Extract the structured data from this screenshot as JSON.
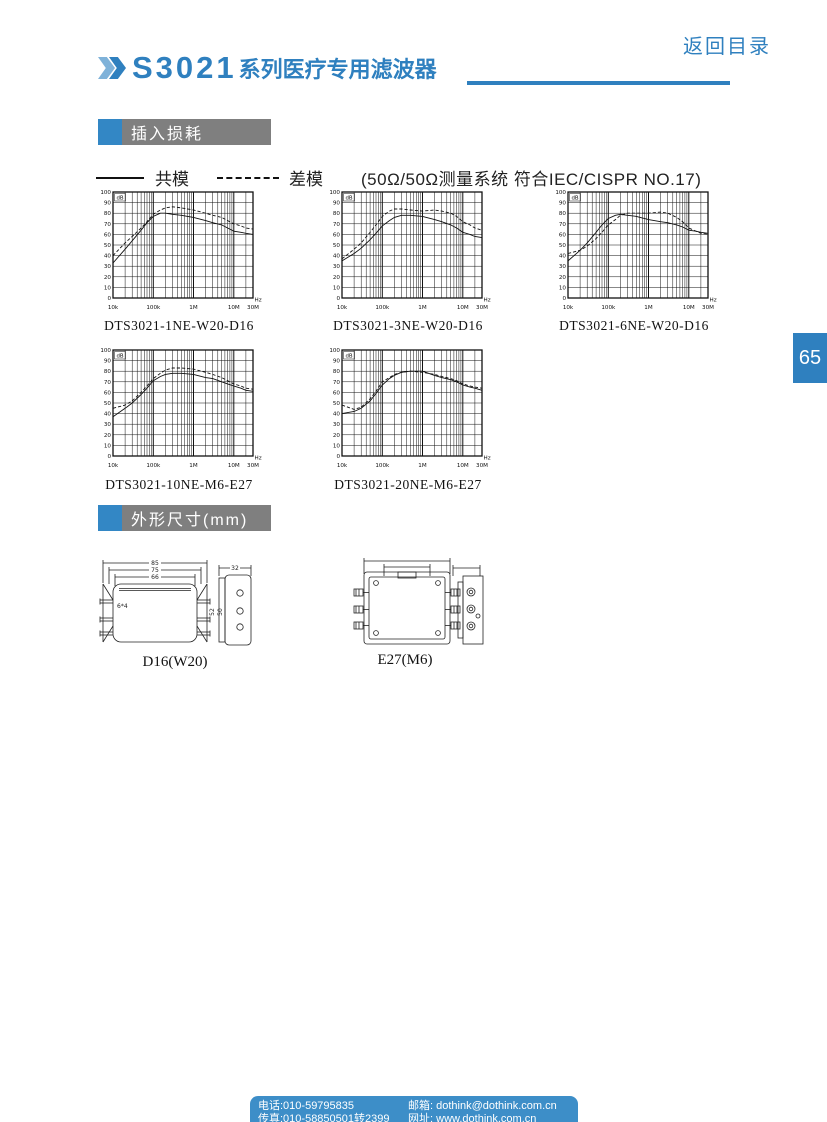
{
  "page": {
    "back_link": "返回目录",
    "page_number": "65"
  },
  "header": {
    "series_code": "S3021",
    "series_suffix": "系列医疗专用滤波器"
  },
  "sections": {
    "insertion_loss": "插入损耗",
    "dimensions": "外形尺寸(mm)"
  },
  "legend": {
    "common_mode": "共模",
    "differential_mode": "差模",
    "note": "(50Ω/50Ω测量系统 符合IEC/CISPR NO.17)"
  },
  "colors": {
    "accent_blue": "#2f80bf",
    "section_gray": "#7f7f7f",
    "footer_blue": "#3d8ec8",
    "line_black": "#111111"
  },
  "chart_data": [
    {
      "type": "line",
      "title": "DTS3021-1NE-W20-D16",
      "xlabel": "Hz",
      "ylabel": "dB",
      "x_scale": "log",
      "xlim": [
        10000,
        30000000
      ],
      "ylim": [
        0,
        100
      ],
      "y_tick_step": 10,
      "x_ticks": [
        "10k",
        "100k",
        "1M",
        "10M",
        "30M"
      ],
      "x_tick_values": [
        10000,
        100000,
        1000000,
        10000000,
        30000000
      ],
      "series": [
        {
          "name": "共模",
          "style": "solid",
          "x": [
            10000,
            20000,
            30000,
            50000,
            70000,
            100000,
            150000,
            200000,
            300000,
            500000,
            1000000,
            2000000,
            3000000,
            5000000,
            7000000,
            10000000,
            15000000,
            20000000,
            30000000
          ],
          "y": [
            33,
            46,
            54,
            64,
            71,
            77,
            80,
            80,
            79,
            78,
            76,
            73,
            71,
            69,
            66,
            63,
            62,
            61,
            60
          ]
        },
        {
          "name": "差模",
          "style": "dashed",
          "x": [
            10000,
            20000,
            30000,
            50000,
            70000,
            100000,
            150000,
            200000,
            300000,
            500000,
            1000000,
            2000000,
            3000000,
            5000000,
            7000000,
            10000000,
            15000000,
            20000000,
            30000000
          ],
          "y": [
            40,
            52,
            58,
            66,
            72,
            79,
            83,
            85,
            86,
            85,
            83,
            80,
            78,
            76,
            73,
            70,
            68,
            66,
            65
          ]
        }
      ]
    },
    {
      "type": "line",
      "title": "DTS3021-3NE-W20-D16",
      "xlabel": "Hz",
      "ylabel": "dB",
      "x_scale": "log",
      "xlim": [
        10000,
        30000000
      ],
      "ylim": [
        0,
        100
      ],
      "y_tick_step": 10,
      "x_ticks": [
        "10k",
        "100k",
        "1M",
        "10M",
        "30M"
      ],
      "x_tick_values": [
        10000,
        100000,
        1000000,
        10000000,
        30000000
      ],
      "series": [
        {
          "name": "共模",
          "style": "solid",
          "x": [
            10000,
            20000,
            30000,
            50000,
            70000,
            100000,
            150000,
            200000,
            300000,
            500000,
            1000000,
            2000000,
            3000000,
            5000000,
            7000000,
            10000000,
            15000000,
            20000000,
            30000000
          ],
          "y": [
            35,
            42,
            47,
            55,
            61,
            68,
            73,
            76,
            78,
            78,
            77,
            74,
            72,
            69,
            66,
            62,
            60,
            58,
            57
          ]
        },
        {
          "name": "差模",
          "style": "dashed",
          "x": [
            10000,
            20000,
            30000,
            50000,
            70000,
            100000,
            150000,
            200000,
            300000,
            500000,
            1000000,
            2000000,
            3000000,
            5000000,
            7000000,
            10000000,
            15000000,
            20000000,
            30000000
          ],
          "y": [
            37,
            46,
            52,
            62,
            69,
            77,
            82,
            84,
            84,
            83,
            82,
            83,
            82,
            80,
            77,
            72,
            69,
            66,
            64
          ]
        }
      ]
    },
    {
      "type": "line",
      "title": "DTS3021-6NE-W20-D16",
      "xlabel": "Hz",
      "ylabel": "dB",
      "x_scale": "log",
      "xlim": [
        10000,
        30000000
      ],
      "ylim": [
        0,
        100
      ],
      "y_tick_step": 10,
      "x_ticks": [
        "10k",
        "100k",
        "1M",
        "10M",
        "30M"
      ],
      "x_tick_values": [
        10000,
        100000,
        1000000,
        10000000,
        30000000
      ],
      "series": [
        {
          "name": "共模",
          "style": "solid",
          "x": [
            10000,
            20000,
            30000,
            50000,
            70000,
            100000,
            150000,
            200000,
            300000,
            500000,
            1000000,
            2000000,
            3000000,
            5000000,
            7000000,
            10000000,
            15000000,
            20000000,
            30000000
          ],
          "y": [
            35,
            45,
            52,
            62,
            69,
            75,
            78,
            79,
            78,
            77,
            74,
            72,
            71,
            69,
            67,
            64,
            63,
            62,
            61
          ]
        },
        {
          "name": "差模",
          "style": "dashed",
          "x": [
            10000,
            20000,
            30000,
            50000,
            70000,
            100000,
            150000,
            200000,
            300000,
            500000,
            1000000,
            2000000,
            3000000,
            5000000,
            7000000,
            10000000,
            15000000,
            20000000,
            30000000
          ],
          "y": [
            42,
            45,
            49,
            56,
            62,
            69,
            74,
            78,
            80,
            80,
            80,
            81,
            80,
            76,
            72,
            66,
            63,
            61,
            60
          ]
        }
      ]
    },
    {
      "type": "line",
      "title": "DTS3021-10NE-M6-E27",
      "xlabel": "Hz",
      "ylabel": "dB",
      "x_scale": "log",
      "xlim": [
        10000,
        30000000
      ],
      "ylim": [
        0,
        100
      ],
      "y_tick_step": 10,
      "x_ticks": [
        "10k",
        "100k",
        "1M",
        "10M",
        "30M"
      ],
      "x_tick_values": [
        10000,
        100000,
        1000000,
        10000000,
        30000000
      ],
      "series": [
        {
          "name": "共模",
          "style": "solid",
          "x": [
            10000,
            20000,
            30000,
            50000,
            70000,
            100000,
            150000,
            200000,
            300000,
            500000,
            1000000,
            2000000,
            3000000,
            5000000,
            7000000,
            10000000,
            15000000,
            20000000,
            30000000
          ],
          "y": [
            37,
            45,
            50,
            58,
            64,
            71,
            75,
            77,
            78,
            78,
            77,
            74,
            73,
            70,
            68,
            66,
            64,
            62,
            61
          ]
        },
        {
          "name": "差模",
          "style": "dashed",
          "x": [
            10000,
            20000,
            30000,
            50000,
            70000,
            100000,
            150000,
            200000,
            300000,
            500000,
            1000000,
            2000000,
            3000000,
            5000000,
            7000000,
            10000000,
            15000000,
            20000000,
            30000000
          ],
          "y": [
            45,
            48,
            52,
            60,
            66,
            73,
            78,
            81,
            83,
            83,
            82,
            79,
            77,
            74,
            71,
            68,
            66,
            64,
            63
          ]
        }
      ]
    },
    {
      "type": "line",
      "title": "DTS3021-20NE-M6-E27",
      "xlabel": "Hz",
      "ylabel": "dB",
      "x_scale": "log",
      "xlim": [
        10000,
        30000000
      ],
      "ylim": [
        0,
        100
      ],
      "y_tick_step": 10,
      "x_ticks": [
        "10k",
        "100k",
        "1M",
        "10M",
        "30M"
      ],
      "x_tick_values": [
        10000,
        100000,
        1000000,
        10000000,
        30000000
      ],
      "series": [
        {
          "name": "共模",
          "style": "solid",
          "x": [
            10000,
            20000,
            30000,
            50000,
            70000,
            100000,
            150000,
            200000,
            300000,
            500000,
            1000000,
            2000000,
            3000000,
            5000000,
            7000000,
            10000000,
            15000000,
            20000000,
            30000000
          ],
          "y": [
            40,
            42,
            45,
            52,
            59,
            67,
            73,
            76,
            79,
            80,
            80,
            76,
            74,
            72,
            70,
            67,
            65,
            64,
            62
          ]
        },
        {
          "name": "差模",
          "style": "dashed",
          "x": [
            10000,
            20000,
            30000,
            50000,
            70000,
            100000,
            150000,
            200000,
            300000,
            500000,
            1000000,
            2000000,
            3000000,
            5000000,
            7000000,
            10000000,
            15000000,
            20000000,
            30000000
          ],
          "y": [
            48,
            44,
            46,
            54,
            61,
            70,
            74,
            77,
            79,
            80,
            79,
            77,
            75,
            73,
            71,
            68,
            66,
            65,
            64
          ]
        }
      ]
    }
  ],
  "drawings": [
    {
      "label": "D16(W20)",
      "dims": {
        "width_outer": "85",
        "width_mid": "75",
        "width_inner": "66",
        "hole": "6*4",
        "side_width": "32",
        "height_outer": "52",
        "height_inner": "50"
      }
    },
    {
      "label": "E27(M6)",
      "dims": {}
    }
  ],
  "footer": {
    "phone": "电话:010-59795835",
    "fax": "传真:010-58850501转2399",
    "email_label": "邮箱:",
    "email": "dothink@dothink.com.cn",
    "web_label": "网址:",
    "website": "www.dothink.com.cn"
  }
}
